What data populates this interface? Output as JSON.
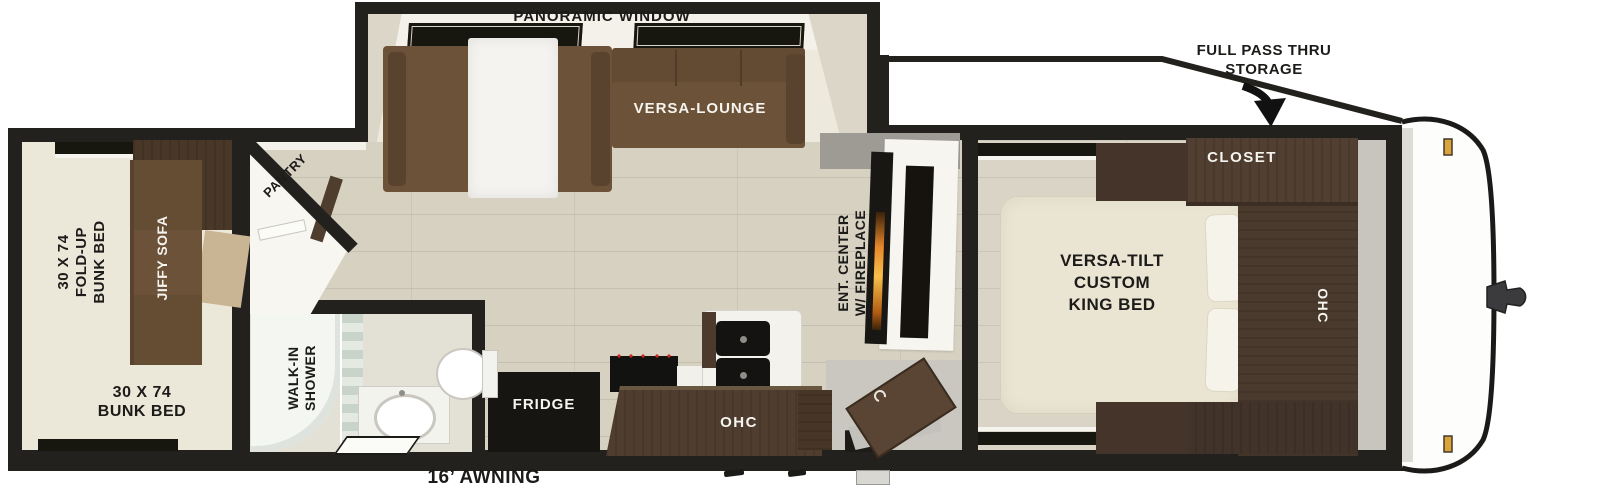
{
  "floorplan": {
    "labels": {
      "panoramic_window": "PANORAMIC WINDOW",
      "versa_lounge": "VERSA-LOUNGE",
      "full_pass_thru": [
        "FULL PASS THRU",
        "STORAGE"
      ],
      "closet": "CLOSET",
      "king_bed": [
        "VERSA-TILT",
        "CUSTOM",
        "KING BED"
      ],
      "bedroom_ohc": "OHC",
      "ent_center": [
        "ENT. CENTER",
        "W/ FIREPLACE"
      ],
      "fridge": "FRIDGE",
      "kitchen_ohc": "OHC",
      "walk_in_shower": [
        "WALK-IN",
        "SHOWER"
      ],
      "pantry": "PANTRY",
      "fold_up_bunk": [
        "30 X 74",
        "FOLD-UP",
        "BUNK BED"
      ],
      "jiffy_sofa": "JIFFY SOFA",
      "bunk_bed": [
        "30 X 74",
        "BUNK BED"
      ],
      "awning": "16’ AWNING"
    },
    "colors": {
      "wall": "#23211e",
      "sofa_brown": "#6c5238",
      "cabinet_brown": "#4c3b2e",
      "floor": "#d6d1c1",
      "bunk_cream": "#ebe7d9",
      "bed_cream": "#eae5d2",
      "flame_orange": "#e8872b",
      "marker_amber": "#d9a43c",
      "burner_red": "#c9271d"
    }
  }
}
